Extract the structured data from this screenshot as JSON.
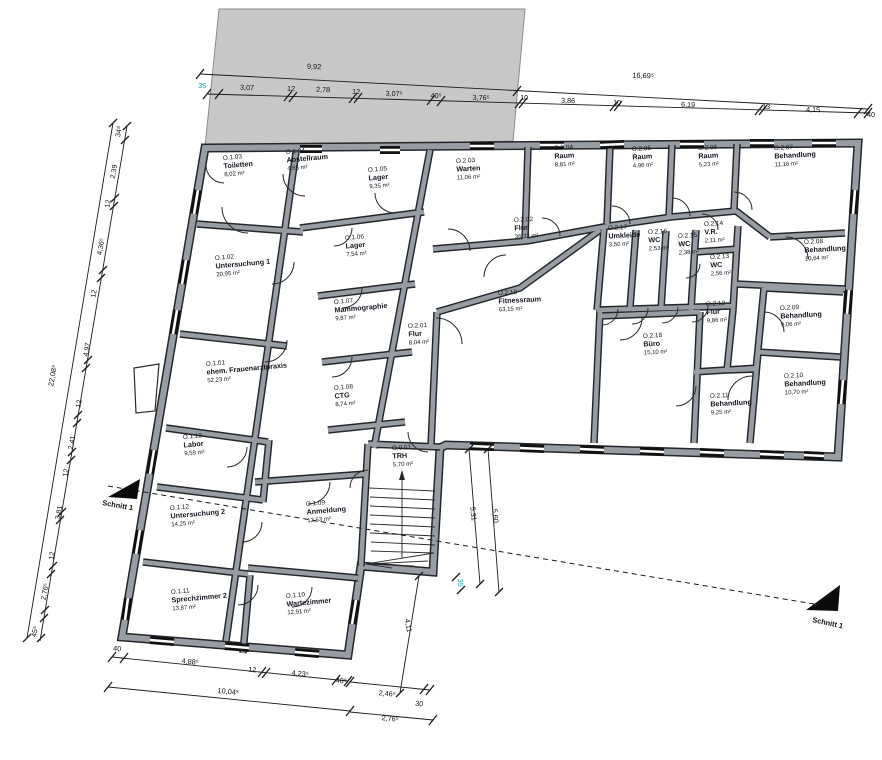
{
  "rooms": [
    {
      "id": "O.0.01",
      "name": "TRH",
      "area": "5,70 m²"
    },
    {
      "id": "O.1.01",
      "name": "ehem. Frauenarztpraxis",
      "area": "52,23 m²"
    },
    {
      "id": "O.1.02",
      "name": "Untersuchung 1",
      "area": "20,95 m²"
    },
    {
      "id": "O.1.03",
      "name": "Toiletten",
      "area": "8,02 m²"
    },
    {
      "id": "O.1.04",
      "name": "Abstellraum",
      "area": "4,65 m²"
    },
    {
      "id": "O.1.05",
      "name": "Lager",
      "area": "9,35 m²"
    },
    {
      "id": "O.1.06",
      "name": "Lager",
      "area": "7,54 m²"
    },
    {
      "id": "O.1.07",
      "name": "Mammographie",
      "area": "9,87 m²"
    },
    {
      "id": "O.1.08",
      "name": "CTG",
      "area": "8,74 m²"
    },
    {
      "id": "O.1.09",
      "name": "Anmeldung",
      "area": "12,53 m²"
    },
    {
      "id": "O.1.10",
      "name": "Wartezimmer",
      "area": "12,91 m²"
    },
    {
      "id": "O.1.11",
      "name": "Sprechzimmer 2",
      "area": "13,87 m²"
    },
    {
      "id": "O.1.12",
      "name": "Untersuchung 2",
      "area": "14,25 m²"
    },
    {
      "id": "O.1.13",
      "name": "Labor",
      "area": "9,59 m²"
    },
    {
      "id": "O.2.01",
      "name": "Flur",
      "area": "8,04 m²"
    },
    {
      "id": "O.2.02",
      "name": "Flur",
      "area": "36,32 m²"
    },
    {
      "id": "O.2.03",
      "name": "Warten",
      "area": "11,06 m²"
    },
    {
      "id": "O.2.04",
      "name": "Raum",
      "area": "8,81 m²"
    },
    {
      "id": "O.2.05",
      "name": "Raum",
      "area": "4,96 m²"
    },
    {
      "id": "O.2.06",
      "name": "Raum",
      "area": "5,23 m²"
    },
    {
      "id": "O.2.07",
      "name": "Behandlung",
      "area": "11,16 m²"
    },
    {
      "id": "O.2.08",
      "name": "Behandlung",
      "area": "10,64 m²"
    },
    {
      "id": "O.2.09",
      "name": "Behandlung",
      "area": "9,06 m²"
    },
    {
      "id": "O.2.10",
      "name": "Behandlung",
      "area": "10,70 m²"
    },
    {
      "id": "O.2.11",
      "name": "Behandlung",
      "area": "9,25 m²"
    },
    {
      "id": "O.2.12",
      "name": "Flur",
      "area": "9,86 m²"
    },
    {
      "id": "O.2.13",
      "name": "WC",
      "area": "2,56 m²"
    },
    {
      "id": "O.2.14",
      "name": "V.R.",
      "area": "2,11 m²"
    },
    {
      "id": "O.2.15",
      "name": "WC",
      "area": "2,38 m²"
    },
    {
      "id": "O.2.16",
      "name": "WC",
      "area": "2,53 m²"
    },
    {
      "id": "O.2.17",
      "name": "Umkleide",
      "area": "3,50 m²"
    },
    {
      "id": "O.2.18",
      "name": "Büro",
      "area": "15,10 m²"
    },
    {
      "id": "O.2.19",
      "name": "Fitnessraum",
      "area": "63,15 m²"
    }
  ],
  "dims": {
    "top_total_left": "9,92",
    "top_total_right": "16,69⁵",
    "top_segments": [
      "35",
      "3,07",
      "12",
      "2,78",
      "12",
      "3,07⁵",
      "40⁵",
      "3,76⁵",
      "10",
      "3,86",
      "10",
      "6,19",
      "13",
      "4,15",
      "40"
    ],
    "left_total": "22,08⁵",
    "left_segments": [
      "34⁸",
      "2,39",
      "12",
      "4,36⁵",
      "12",
      "4,97",
      "12",
      "2,41",
      "12",
      "3,81",
      "12",
      "2,76⁵",
      "45⁵"
    ],
    "bottom_segments": [
      "40",
      "4,88⁵",
      "12",
      "4,23⁵",
      "40⁵"
    ],
    "bottom_total": "10,04⁵",
    "bottom_right_upper": "2,46⁵",
    "bottom_right_tick": "30",
    "bottom_right_lower": "2,76⁵",
    "stair_right_inner": "5,31",
    "stair_right_outer": "5,60",
    "stair_bottom": "4,11",
    "stair_tick": "35"
  },
  "section": {
    "left_label": "Schnitt 1",
    "right_label": "Schnitt 1"
  },
  "colors": {
    "wall_fill": "#989da3",
    "wall_edge": "#23272b",
    "neighbor_building": "#c8c8c8",
    "label_text": "#15151f",
    "dimension_text": "#101010",
    "small_dim_accent": "#0a9aa2",
    "background": "#ffffff"
  }
}
